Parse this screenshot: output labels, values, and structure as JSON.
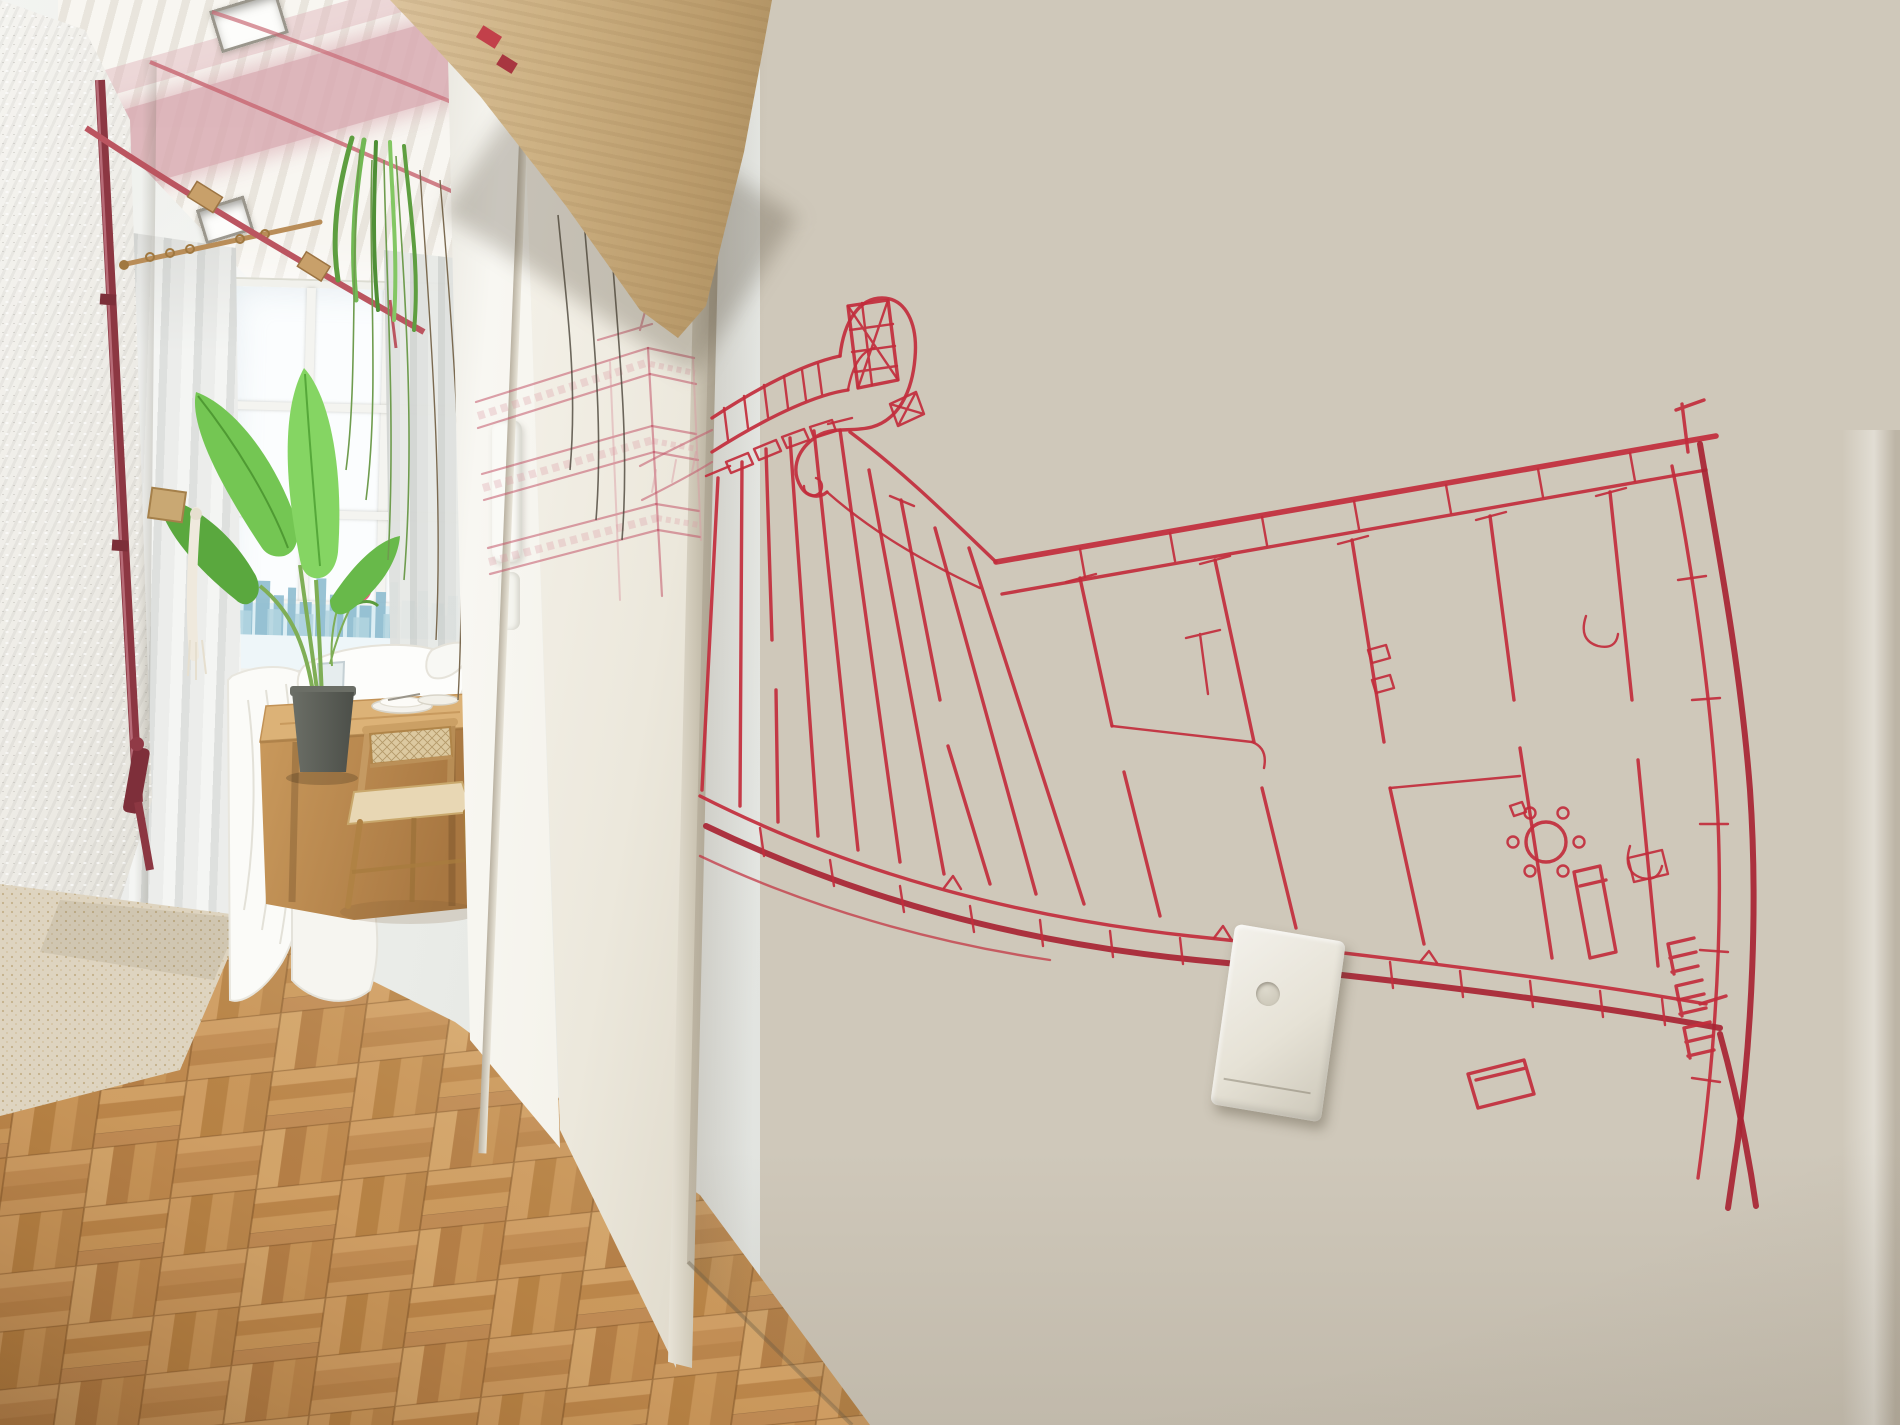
{
  "meta": {
    "scene_type": "photograph",
    "description": "Narrow apartment hallway with a red hand-drawn floor-plan mural on the wall, sliding door, exposed pipes and a bedroom visible at the end"
  },
  "palette": {
    "mural_red": "#c22c3c",
    "mural_red_deep": "#a82433",
    "mural_red_soft": "#c2556a",
    "mural_red_faint": "#d998a2",
    "wall_light": "#efe9dc",
    "wall_dark": "#b4a892",
    "door_white": "#f3efe6",
    "metal_edge": "#b9b0a0",
    "beam_light": "#dcc49e",
    "beam_dark": "#a98c5e",
    "ceiling_white": "#f8f6f1",
    "ceiling_slat": "#e9e5dd",
    "ceiling_pink": "#d8a9b0",
    "pipe_red": "#b9505c",
    "pipe_dark": "#8c3742",
    "plant_green": "#74c653",
    "city_blue": "#95c2d3",
    "wood_table": "#cf9f63",
    "rug": "#e8decb",
    "floor_light": "#dcab6f",
    "floor_dark": "#a87743",
    "switch_plate": "#eceade"
  },
  "scene": {
    "hallway": {
      "label": "Narrow hallway with herringbone parquet floor"
    },
    "mural": {
      "label": "Red hand-drawn floor plan mural of a curved apartment block"
    },
    "facade_sketch": {
      "label": "Faint red sketch of the building facade on the sliding door"
    },
    "light_switch": {
      "label": "White light switch plate on the mural wall"
    },
    "sliding_door": {
      "label": "White sliding door panel"
    },
    "door_frame": {
      "label": "White doorway column"
    },
    "beam": {
      "label": "Exposed light wood beam above the door"
    },
    "ceiling": {
      "label": "White slatted ceiling with pink stripe, spotlights and red conduit"
    },
    "pipes": {
      "label": "Exposed red painted pipes"
    },
    "textured_wall": {
      "label": "Rough white plaster wall"
    },
    "bedroom": {
      "label": "Bedroom at the end of the hallway"
    },
    "window": {
      "label": "Large window with white mullions and city skyline view"
    },
    "plant": {
      "label": "Banana leaf plant in a dark pot"
    },
    "hanging_plant": {
      "label": "Hanging plant with trailing tendrils"
    },
    "bed": {
      "label": "Bed with white duvet and pillows"
    },
    "table": {
      "label": "Wooden table with plates and a flower vase"
    },
    "chair": {
      "label": "Wooden chair with cane backrest"
    },
    "rug": {
      "label": "Cream speckled rug"
    },
    "floor": {
      "label": "Honey-toned parquet floor"
    },
    "stairs_mark": {
      "label": "Stair symbols drawn at the plan corner"
    }
  }
}
